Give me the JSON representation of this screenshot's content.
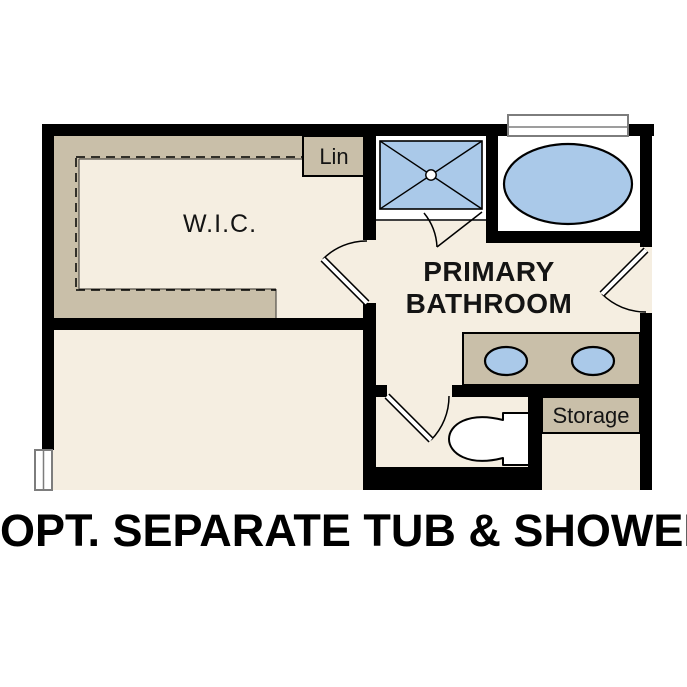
{
  "floor_plan": {
    "labels": {
      "wic": "W.I.C.",
      "linen": "Lin",
      "bathroom_line1": "PRIMARY",
      "bathroom_line2": "BATHROOM",
      "storage": "Storage"
    },
    "caption": "OPT. SEPARATE TUB & SHOWER",
    "colors": {
      "wall": "#000000",
      "floor": "#f5eee1",
      "casework": "#c9bfa9",
      "fixture_fill": "#aac9e9",
      "surround": "#ffffff",
      "window_frame": "#7d7d7d",
      "thin_outline": "#54504a"
    }
  }
}
